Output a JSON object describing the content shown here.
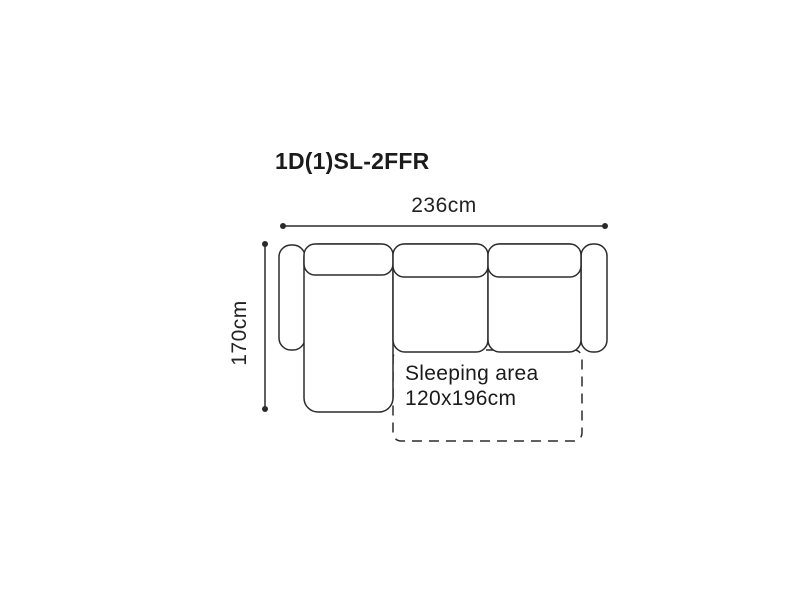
{
  "diagram": {
    "title": "1D(1)SL-2FFR",
    "dimensions": {
      "width_label": "236cm",
      "depth_label": "170cm"
    },
    "sleeping_area": {
      "label_line1": "Sleeping area",
      "label_line2": "120x196cm"
    },
    "colors": {
      "outline": "#2b2b2b",
      "text": "#1b1b1b",
      "background": "#ffffff"
    }
  }
}
